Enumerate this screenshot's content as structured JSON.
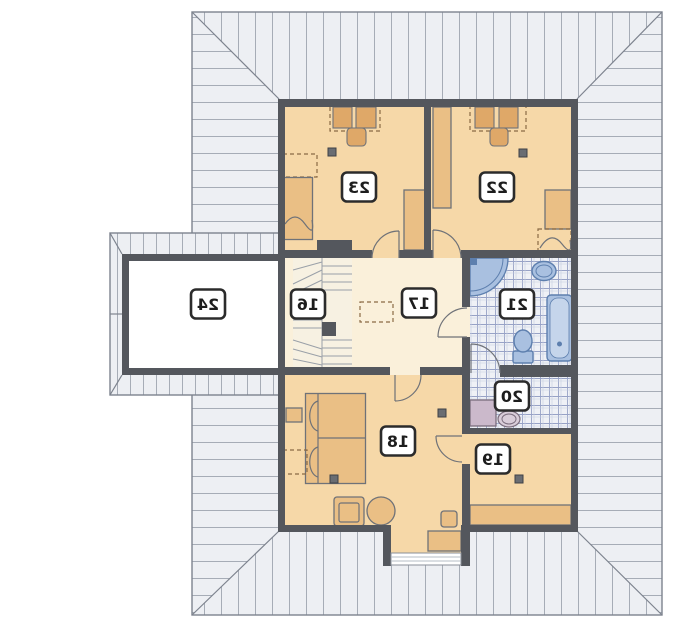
{
  "rooms": {
    "r16": {
      "label": "16"
    },
    "r17": {
      "label": "17"
    },
    "r18": {
      "label": "18"
    },
    "r19": {
      "label": "19"
    },
    "r20": {
      "label": "20"
    },
    "r21": {
      "label": "21"
    },
    "r22": {
      "label": "22"
    },
    "r23": {
      "label": "23"
    },
    "r24": {
      "label": "24"
    }
  },
  "palette": {
    "background": "#ffffff",
    "roof_fill": "#edeff3",
    "roof_stripe": "#a6acb6",
    "roof_outline": "#7d838e",
    "wall": "#54575d",
    "room_fill": "#f6d8a8",
    "hall_fill": "#faf0da",
    "stairs_fill": "#f7f1e2",
    "furniture_fill": "#eabf85",
    "furniture_dark": "#dfa868",
    "furniture_stroke": "#6f7278",
    "tile_fill": "#eff1f6",
    "tile_line": "#97a2c6",
    "fixture_fill": "#a9c0e0",
    "fixture_stroke": "#5d7fae",
    "washer_fill": "#cbb9cb",
    "label_bg": "#ffffff",
    "label_border": "#2b2b2b",
    "label_text": "#1d1d1d",
    "dash_color": "#8a6a45"
  }
}
